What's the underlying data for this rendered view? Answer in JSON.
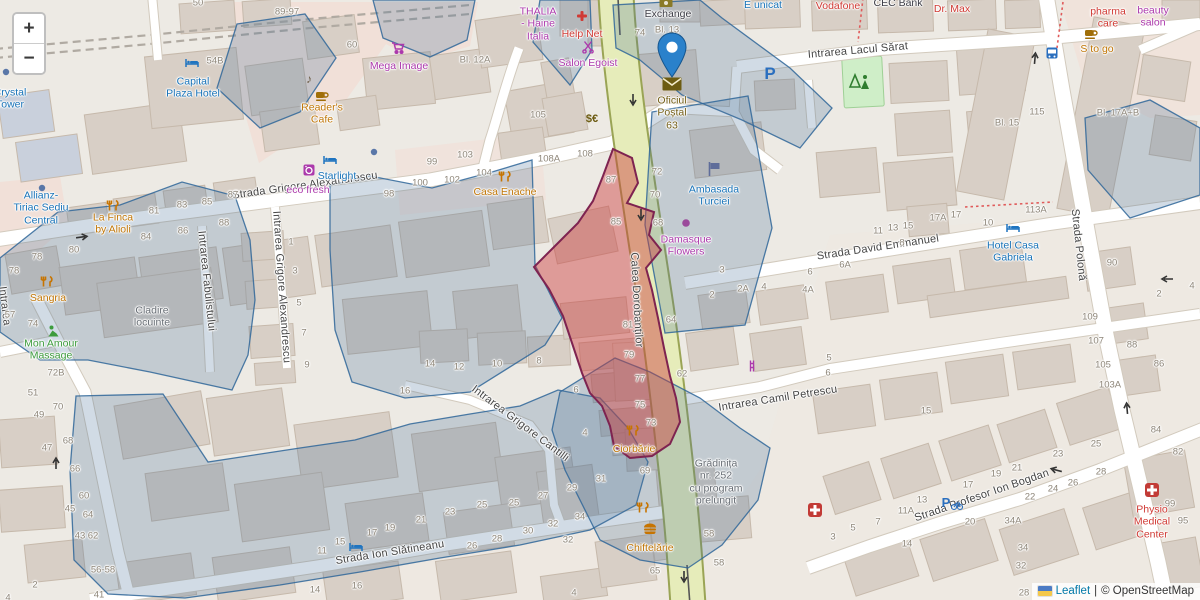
{
  "controls": {
    "zoom_in": "+",
    "zoom_out": "−"
  },
  "attribution": {
    "flag": "ukraine-flag",
    "leaflet": "Leaflet",
    "separator": "|",
    "osm": "© OpenStreetMap"
  },
  "marker": {
    "location_label": "Oficiul Poștal 63"
  },
  "colors": {
    "marker_blue": "#2A81CB",
    "highlight_fill": "rgba(205,60,60,0.45)",
    "highlight_stroke": "#7e2350",
    "overlay_fill": "rgba(70,110,150,0.25)",
    "overlay_stroke": "#2f6699",
    "road_major_fill": "#e6ecba",
    "road_major_casing": "#9aa455",
    "poi_blue": "#1873b8",
    "poi_purple": "#ac39ac",
    "poi_orange": "#c07607",
    "poi_red": "#d03a34",
    "poi_green": "#3d9c3d",
    "poi_olive": "#756019",
    "poi_gray": "#676d74"
  },
  "map": {
    "streets": [
      {
        "t": "Strada Grigore Alexandrescu",
        "x": 305,
        "y": 186,
        "r": -8
      },
      {
        "t": "Intrarea Lacul Sărat",
        "x": 858,
        "y": 51,
        "r": -5
      },
      {
        "t": "Strada David Emmanuel",
        "x": 878,
        "y": 248,
        "r": -8.5
      },
      {
        "t": "Intrarea Camil Petrescu",
        "x": 778,
        "y": 399,
        "r": -9
      },
      {
        "t": "Strada Profesor Ion Bogdan",
        "x": 982,
        "y": 496,
        "r": -19
      },
      {
        "t": "Strada Ion Slătineanu",
        "x": 390,
        "y": 553,
        "r": -9
      },
      {
        "t": "Strada Polonă",
        "x": 1078,
        "y": 245,
        "r": 84
      },
      {
        "t": "Calea Dorobanților",
        "x": 636,
        "y": 300,
        "r": 87
      },
      {
        "t": "Intrarea Fabulistului",
        "x": 206,
        "y": 281,
        "r": 84
      },
      {
        "t": "Intrarea Grigore Alexandrescu",
        "x": 281,
        "y": 287,
        "r": 86
      },
      {
        "t": "Intrarea Grigore Cantilli",
        "x": 520,
        "y": 424,
        "r": 37
      },
      {
        "t": "Intrarea",
        "x": 4,
        "y": 306,
        "r": 83
      }
    ],
    "pois": [
      {
        "t": "Crystal\nTower",
        "x": 10,
        "y": 99,
        "c": "blue"
      },
      {
        "t": "Capital\nPlaza Hotel",
        "x": 193,
        "y": 88,
        "c": "blue"
      },
      {
        "t": "Reader's\nCafe",
        "x": 322,
        "y": 114,
        "c": "orange"
      },
      {
        "t": "Mega Image",
        "x": 399,
        "y": 66,
        "c": "purple"
      },
      {
        "t": "THALIA\n- Haine\nItalia",
        "x": 538,
        "y": 24,
        "c": "purple"
      },
      {
        "t": "Help Net",
        "x": 582,
        "y": 34,
        "c": "red"
      },
      {
        "t": "Salon Egoist",
        "x": 588,
        "y": 63,
        "c": "purple"
      },
      {
        "t": "Exchange",
        "x": 668,
        "y": 14,
        "c": "dark"
      },
      {
        "t": "E unicat",
        "x": 763,
        "y": 5,
        "c": "blue"
      },
      {
        "t": "Vodafone",
        "x": 838,
        "y": 6,
        "c": "red"
      },
      {
        "t": "CEC Bank",
        "x": 898,
        "y": 3,
        "c": "dark"
      },
      {
        "t": "Dr. Max",
        "x": 952,
        "y": 9,
        "c": "red"
      },
      {
        "t": "pharma\ncare",
        "x": 1108,
        "y": 18,
        "c": "red"
      },
      {
        "t": "beauty\nsalon",
        "x": 1153,
        "y": 17,
        "c": "purple"
      },
      {
        "t": "S to go",
        "x": 1097,
        "y": 49,
        "c": "orange"
      },
      {
        "t": "Oficiul\nPoștal\n63",
        "x": 672,
        "y": 113,
        "c": "olive"
      },
      {
        "t": "Ambasada\nTurciei",
        "x": 714,
        "y": 196,
        "c": "blue"
      },
      {
        "t": "Damasque\nFlowers",
        "x": 686,
        "y": 246,
        "c": "purple"
      },
      {
        "t": "Hotel Casa\nGabriela",
        "x": 1013,
        "y": 252,
        "c": "blue"
      },
      {
        "t": "Starlight",
        "x": 337,
        "y": 176,
        "c": "blue"
      },
      {
        "t": "eco fresh",
        "x": 308,
        "y": 190,
        "c": "purple"
      },
      {
        "t": "Casa Enache",
        "x": 505,
        "y": 192,
        "c": "orange"
      },
      {
        "t": "La Finca\nby Alioli",
        "x": 113,
        "y": 224,
        "c": "orange"
      },
      {
        "t": "Allianz-\nTiriac Sediu\nCentral",
        "x": 41,
        "y": 208,
        "c": "blue"
      },
      {
        "t": "Sangria",
        "x": 48,
        "y": 298,
        "c": "orange"
      },
      {
        "t": "Mon Amour\nMassage",
        "x": 51,
        "y": 350,
        "c": "green"
      },
      {
        "t": "Cladire\nlocuinte",
        "x": 152,
        "y": 317,
        "c": "gray"
      },
      {
        "t": "Ciorbărie",
        "x": 634,
        "y": 449,
        "c": "orange"
      },
      {
        "t": "Grădinița\nnr. 252\ncu program\nprelungit",
        "x": 716,
        "y": 482,
        "c": "gray"
      },
      {
        "t": "Chiftelărie",
        "x": 650,
        "y": 548,
        "c": "orange"
      },
      {
        "t": "Physio\nMedical\nCenter",
        "x": 1152,
        "y": 522,
        "c": "red"
      }
    ],
    "numbers": [
      {
        "t": "50",
        "x": 198,
        "y": 3
      },
      {
        "t": "89-97",
        "x": 287,
        "y": 12
      },
      {
        "t": "54B",
        "x": 215,
        "y": 61
      },
      {
        "t": "60",
        "x": 352,
        "y": 45
      },
      {
        "t": "Bl. 12A",
        "x": 475,
        "y": 60
      },
      {
        "t": "105",
        "x": 538,
        "y": 115
      },
      {
        "t": "99",
        "x": 432,
        "y": 162
      },
      {
        "t": "103",
        "x": 465,
        "y": 155
      },
      {
        "t": "100",
        "x": 420,
        "y": 183
      },
      {
        "t": "102",
        "x": 452,
        "y": 180
      },
      {
        "t": "104",
        "x": 484,
        "y": 173
      },
      {
        "t": "108A",
        "x": 549,
        "y": 159
      },
      {
        "t": "108",
        "x": 585,
        "y": 154
      },
      {
        "t": "87",
        "x": 611,
        "y": 180
      },
      {
        "t": "74",
        "x": 640,
        "y": 33
      },
      {
        "t": "Bl. 13",
        "x": 667,
        "y": 30
      },
      {
        "t": "72",
        "x": 657,
        "y": 172
      },
      {
        "t": "70",
        "x": 655,
        "y": 195
      },
      {
        "t": "68",
        "x": 658,
        "y": 223
      },
      {
        "t": "85",
        "x": 616,
        "y": 222
      },
      {
        "t": "Bl. 15",
        "x": 1007,
        "y": 123
      },
      {
        "t": "115",
        "x": 1037,
        "y": 112
      },
      {
        "t": "Bl. 17A+B",
        "x": 1118,
        "y": 113
      },
      {
        "t": "78",
        "x": 37,
        "y": 257
      },
      {
        "t": "78",
        "x": 14,
        "y": 271
      },
      {
        "t": "80",
        "x": 74,
        "y": 250
      },
      {
        "t": "84",
        "x": 146,
        "y": 237
      },
      {
        "t": "86",
        "x": 183,
        "y": 231
      },
      {
        "t": "88",
        "x": 224,
        "y": 223
      },
      {
        "t": "81",
        "x": 154,
        "y": 211
      },
      {
        "t": "83",
        "x": 182,
        "y": 205
      },
      {
        "t": "85",
        "x": 207,
        "y": 202
      },
      {
        "t": "87",
        "x": 233,
        "y": 195
      },
      {
        "t": "98",
        "x": 389,
        "y": 194
      },
      {
        "t": "57",
        "x": 10,
        "y": 315
      },
      {
        "t": "74",
        "x": 33,
        "y": 324
      },
      {
        "t": "72B",
        "x": 56,
        "y": 373
      },
      {
        "t": "1",
        "x": 291,
        "y": 242
      },
      {
        "t": "3",
        "x": 295,
        "y": 271
      },
      {
        "t": "5",
        "x": 299,
        "y": 303
      },
      {
        "t": "7",
        "x": 304,
        "y": 333
      },
      {
        "t": "9",
        "x": 307,
        "y": 365
      },
      {
        "t": "81",
        "x": 628,
        "y": 325
      },
      {
        "t": "79",
        "x": 629,
        "y": 355
      },
      {
        "t": "77",
        "x": 640,
        "y": 379
      },
      {
        "t": "75",
        "x": 640,
        "y": 405
      },
      {
        "t": "73",
        "x": 651,
        "y": 423
      },
      {
        "t": "69",
        "x": 645,
        "y": 471
      },
      {
        "t": "64",
        "x": 671,
        "y": 320
      },
      {
        "t": "62",
        "x": 682,
        "y": 374
      },
      {
        "t": "3",
        "x": 722,
        "y": 270
      },
      {
        "t": "2",
        "x": 712,
        "y": 295
      },
      {
        "t": "2A",
        "x": 743,
        "y": 289
      },
      {
        "t": "4",
        "x": 764,
        "y": 287
      },
      {
        "t": "14",
        "x": 430,
        "y": 364
      },
      {
        "t": "12",
        "x": 459,
        "y": 367
      },
      {
        "t": "10",
        "x": 497,
        "y": 364
      },
      {
        "t": "8",
        "x": 539,
        "y": 361
      },
      {
        "t": "6",
        "x": 576,
        "y": 390
      },
      {
        "t": "16",
        "x": 405,
        "y": 391
      },
      {
        "t": "4",
        "x": 585,
        "y": 433
      },
      {
        "t": "31",
        "x": 601,
        "y": 479
      },
      {
        "t": "29",
        "x": 572,
        "y": 488
      },
      {
        "t": "27",
        "x": 543,
        "y": 496
      },
      {
        "t": "25",
        "x": 514,
        "y": 503
      },
      {
        "t": "11",
        "x": 878,
        "y": 231
      },
      {
        "t": "13",
        "x": 893,
        "y": 228
      },
      {
        "t": "15",
        "x": 908,
        "y": 226
      },
      {
        "t": "17A",
        "x": 938,
        "y": 218
      },
      {
        "t": "17",
        "x": 956,
        "y": 215
      },
      {
        "t": "10",
        "x": 988,
        "y": 223
      },
      {
        "t": "113A",
        "x": 1036,
        "y": 210
      },
      {
        "t": "8",
        "x": 902,
        "y": 243
      },
      {
        "t": "6A",
        "x": 845,
        "y": 265
      },
      {
        "t": "6",
        "x": 810,
        "y": 272
      },
      {
        "t": "4A",
        "x": 808,
        "y": 290
      },
      {
        "t": "5",
        "x": 829,
        "y": 358
      },
      {
        "t": "6",
        "x": 828,
        "y": 373
      },
      {
        "t": "90",
        "x": 1112,
        "y": 263
      },
      {
        "t": "109",
        "x": 1090,
        "y": 317
      },
      {
        "t": "107",
        "x": 1096,
        "y": 341
      },
      {
        "t": "105",
        "x": 1103,
        "y": 365
      },
      {
        "t": "103A",
        "x": 1110,
        "y": 385
      },
      {
        "t": "88",
        "x": 1132,
        "y": 345
      },
      {
        "t": "86",
        "x": 1159,
        "y": 364
      },
      {
        "t": "2",
        "x": 1159,
        "y": 294
      },
      {
        "t": "4",
        "x": 1192,
        "y": 286
      },
      {
        "t": "51",
        "x": 33,
        "y": 393
      },
      {
        "t": "49",
        "x": 39,
        "y": 415
      },
      {
        "t": "70",
        "x": 58,
        "y": 407
      },
      {
        "t": "47",
        "x": 47,
        "y": 448
      },
      {
        "t": "68",
        "x": 68,
        "y": 441
      },
      {
        "t": "66",
        "x": 75,
        "y": 469
      },
      {
        "t": "60",
        "x": 84,
        "y": 496
      },
      {
        "t": "45",
        "x": 70,
        "y": 509
      },
      {
        "t": "64",
        "x": 88,
        "y": 515
      },
      {
        "t": "43",
        "x": 80,
        "y": 536
      },
      {
        "t": "62",
        "x": 93,
        "y": 536
      },
      {
        "t": "56-58",
        "x": 103,
        "y": 570
      },
      {
        "t": "41",
        "x": 99,
        "y": 595
      },
      {
        "t": "2",
        "x": 35,
        "y": 585
      },
      {
        "t": "4",
        "x": 8,
        "y": 598
      },
      {
        "t": "11",
        "x": 322,
        "y": 551
      },
      {
        "t": "15",
        "x": 340,
        "y": 542
      },
      {
        "t": "17",
        "x": 372,
        "y": 533
      },
      {
        "t": "19",
        "x": 390,
        "y": 528
      },
      {
        "t": "21",
        "x": 421,
        "y": 520
      },
      {
        "t": "23",
        "x": 450,
        "y": 512
      },
      {
        "t": "25",
        "x": 482,
        "y": 505
      },
      {
        "t": "26",
        "x": 472,
        "y": 546
      },
      {
        "t": "28",
        "x": 497,
        "y": 539
      },
      {
        "t": "30",
        "x": 528,
        "y": 531
      },
      {
        "t": "32",
        "x": 553,
        "y": 524
      },
      {
        "t": "34",
        "x": 580,
        "y": 517
      },
      {
        "t": "32",
        "x": 568,
        "y": 540
      },
      {
        "t": "65",
        "x": 655,
        "y": 571
      },
      {
        "t": "4",
        "x": 574,
        "y": 593
      },
      {
        "t": "14",
        "x": 315,
        "y": 590
      },
      {
        "t": "16",
        "x": 357,
        "y": 586
      },
      {
        "t": "58",
        "x": 709,
        "y": 534
      },
      {
        "t": "58",
        "x": 719,
        "y": 563
      },
      {
        "t": "15",
        "x": 926,
        "y": 411
      },
      {
        "t": "25",
        "x": 1096,
        "y": 444
      },
      {
        "t": "23",
        "x": 1058,
        "y": 454
      },
      {
        "t": "21",
        "x": 1017,
        "y": 468
      },
      {
        "t": "19",
        "x": 996,
        "y": 474
      },
      {
        "t": "17",
        "x": 968,
        "y": 485
      },
      {
        "t": "13",
        "x": 922,
        "y": 500
      },
      {
        "t": "11A",
        "x": 906,
        "y": 511
      },
      {
        "t": "7",
        "x": 878,
        "y": 522
      },
      {
        "t": "5",
        "x": 853,
        "y": 528
      },
      {
        "t": "3",
        "x": 833,
        "y": 537
      },
      {
        "t": "14",
        "x": 907,
        "y": 544
      },
      {
        "t": "20",
        "x": 970,
        "y": 522
      },
      {
        "t": "34A",
        "x": 1013,
        "y": 521
      },
      {
        "t": "34",
        "x": 1023,
        "y": 548
      },
      {
        "t": "32",
        "x": 1021,
        "y": 566
      },
      {
        "t": "28",
        "x": 1024,
        "y": 593
      },
      {
        "t": "22",
        "x": 1030,
        "y": 497
      },
      {
        "t": "24",
        "x": 1053,
        "y": 489
      },
      {
        "t": "26",
        "x": 1073,
        "y": 483
      },
      {
        "t": "28",
        "x": 1101,
        "y": 472
      },
      {
        "t": "99",
        "x": 1170,
        "y": 504
      },
      {
        "t": "95",
        "x": 1183,
        "y": 521
      },
      {
        "t": "84",
        "x": 1156,
        "y": 430
      },
      {
        "t": "82",
        "x": 1178,
        "y": 452
      }
    ],
    "icons": [
      {
        "n": "cafe-icon",
        "x": 322,
        "y": 96
      },
      {
        "n": "music-note-icon",
        "x": 309,
        "y": 78
      },
      {
        "n": "shopping-cart-icon",
        "x": 398,
        "y": 48
      },
      {
        "n": "pharmacy-cross-icon",
        "x": 582,
        "y": 16
      },
      {
        "n": "scissors-icon",
        "x": 588,
        "y": 47
      },
      {
        "n": "money-icon",
        "x": 666,
        "y": 3
      },
      {
        "n": "envelope-icon",
        "x": 672,
        "y": 84
      },
      {
        "n": "embassy-flag-icon",
        "x": 714,
        "y": 169
      },
      {
        "n": "florist-dot-icon",
        "x": 686,
        "y": 223
      },
      {
        "n": "hotel-bed-icon",
        "x": 1013,
        "y": 228
      },
      {
        "n": "hotel-bed-icon",
        "x": 192,
        "y": 63
      },
      {
        "n": "hotel-bed-icon",
        "x": 330,
        "y": 160
      },
      {
        "n": "hotel-bed-icon",
        "x": 356,
        "y": 547
      },
      {
        "n": "laundry-icon",
        "x": 309,
        "y": 170
      },
      {
        "n": "restaurant-icon",
        "x": 505,
        "y": 177
      },
      {
        "n": "restaurant-icon",
        "x": 113,
        "y": 206
      },
      {
        "n": "restaurant-icon",
        "x": 47,
        "y": 282
      },
      {
        "n": "massage-person-icon",
        "x": 53,
        "y": 331
      },
      {
        "n": "restaurant-icon",
        "x": 633,
        "y": 431
      },
      {
        "n": "restaurant-icon",
        "x": 643,
        "y": 508
      },
      {
        "n": "fastfood-icon",
        "x": 650,
        "y": 529
      },
      {
        "n": "clinic-cross-icon",
        "x": 1152,
        "y": 490
      },
      {
        "n": "clinic-cross-icon",
        "x": 815,
        "y": 510
      },
      {
        "n": "hairdresser-icon",
        "x": 753,
        "y": 366
      },
      {
        "n": "currency-exchange-icon",
        "x": 592,
        "y": 118
      },
      {
        "n": "parking-icon",
        "x": 770,
        "y": 73
      },
      {
        "n": "parking-bike-icon",
        "x": 952,
        "y": 503
      },
      {
        "n": "bus-stop-icon",
        "x": 1052,
        "y": 53
      },
      {
        "n": "poi-dot-icon",
        "x": 42,
        "y": 188
      },
      {
        "n": "poi-dot-icon",
        "x": 374,
        "y": 152
      },
      {
        "n": "poi-dot-icon",
        "x": 6,
        "y": 72
      },
      {
        "n": "playground-icon",
        "x": 860,
        "y": 80
      },
      {
        "n": "cafe-icon",
        "x": 1091,
        "y": 34
      }
    ]
  }
}
